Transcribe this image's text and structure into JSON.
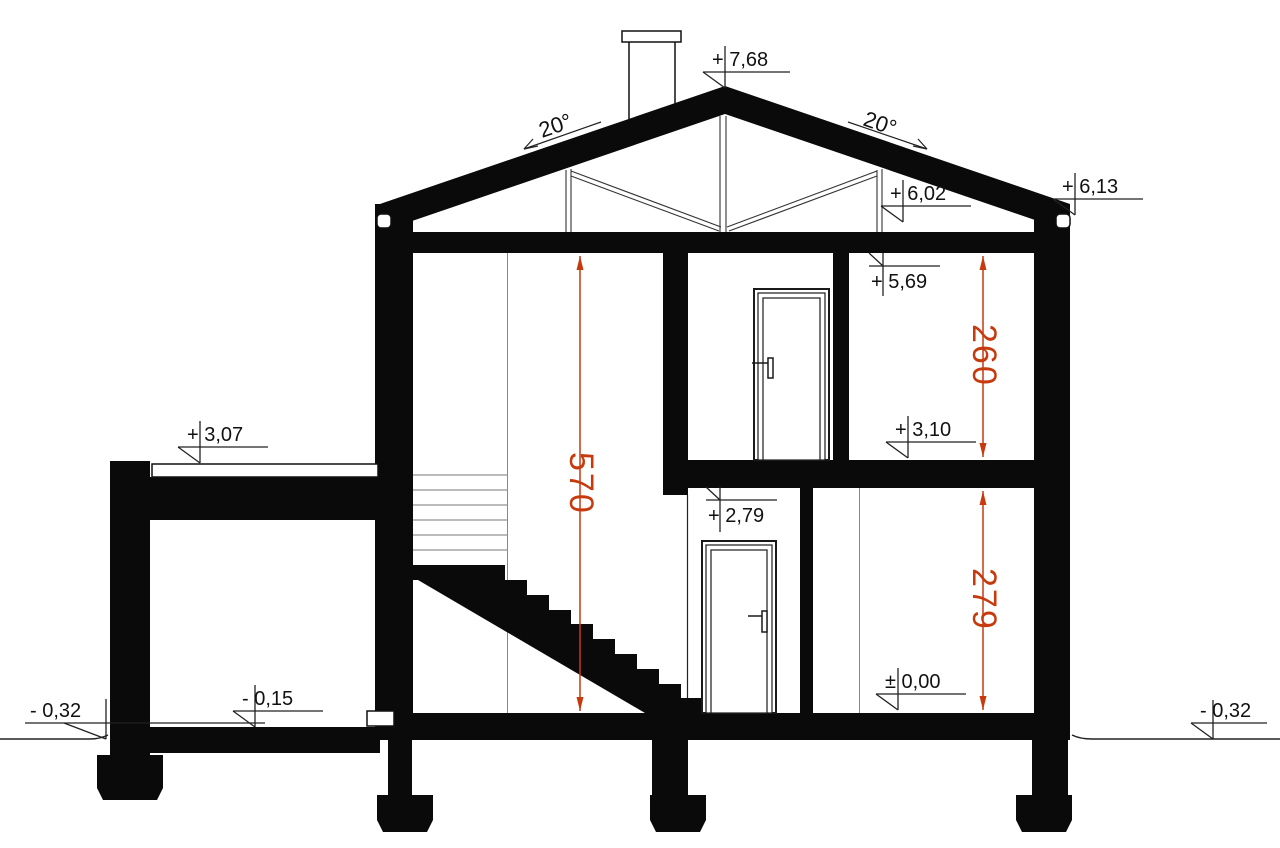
{
  "section": {
    "angle_left": "20°",
    "angle_right": "20°",
    "level_peak": "+ 7,68",
    "level_eave_right": "+ 6,13",
    "level_truss_bottom": "+ 6,02",
    "level_ceiling": "+ 5,69",
    "level_upper_floor": "+ 3,10",
    "level_wing_roof": "+ 3,07",
    "level_door_lintel": "+ 2,79",
    "level_ground_floor": "± 0,00",
    "level_garage_floor": "- 0,15",
    "level_ground_left": "- 0,32",
    "level_ground_right": "- 0,32",
    "dim_stairwell": "570",
    "dim_upper_room": "260",
    "dim_ground_room": "279",
    "colors": {
      "ink": "#0a0a0a",
      "dimension_red": "#c63a0e",
      "thin_line": "#1a1a1a",
      "elevation_line": "#888888"
    }
  }
}
